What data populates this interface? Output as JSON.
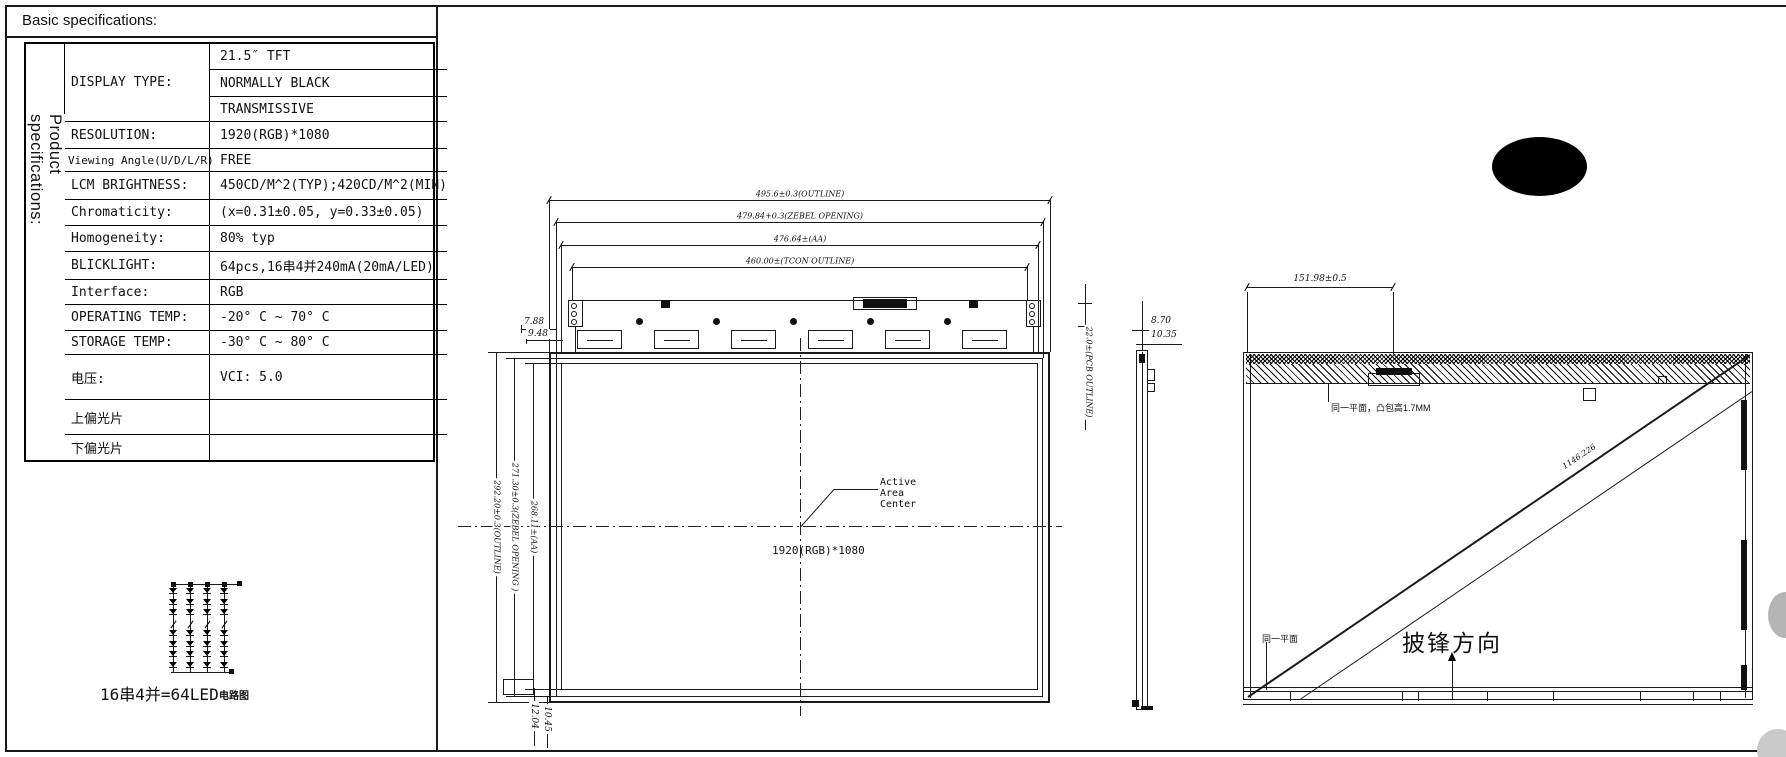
{
  "page": {
    "title": "Basic specifications:",
    "side_header": "Product specifications:"
  },
  "spec_table": {
    "display_type": {
      "label": "DISPLAY TYPE:",
      "values": [
        "21.5″ TFT",
        "NORMALLY BLACK",
        "TRANSMISSIVE"
      ]
    },
    "rows": [
      {
        "label": "RESOLUTION:",
        "value": "1920(RGB)*1080"
      },
      {
        "label": "Viewing Angle(U/D/L/R)",
        "value": "FREE"
      },
      {
        "label": "LCM BRIGHTNESS:",
        "value": "450CD/M^2(TYP);420CD/M^2(MIN)"
      },
      {
        "label": "Chromaticity:",
        "value": "(x=0.31±0.05, y=0.33±0.05)"
      },
      {
        "label": "Homogeneity:",
        "value": "80% typ"
      },
      {
        "label": "BLICKLIGHT:",
        "value": "64pcs,16串4并240mA(20mA/LED)"
      },
      {
        "label": "Interface:",
        "value": "RGB"
      },
      {
        "label": "OPERATING TEMP:",
        "value": "-20° C ~ 70° C"
      },
      {
        "label": "STORAGE TEMP:",
        "value": "-30° C ~ 80° C"
      },
      {
        "label": "电压:",
        "value": "VCI: 5.0"
      },
      {
        "label": "上偏光片",
        "value": ""
      },
      {
        "label": "下偏光片",
        "value": ""
      }
    ]
  },
  "led_diagram": {
    "label_main": "16串4并=64LED",
    "label_suffix": "电路图"
  },
  "front_view": {
    "dims_top": [
      "495.6±0.3(OUTLINE)",
      "479.84+0.3(ZEBEL OPENING)",
      "476.64±(AA)",
      "460.00±(TCON OUTLINE)"
    ],
    "dim_788": "7.88",
    "dim_948": "9.48",
    "dims_left": [
      "292.20±0.3(OUTLINE)",
      "271.30±0.3(ZEBEL OPENING )",
      "268.11±(AA)"
    ],
    "dim_1204": "12.04",
    "dim_1045": "10.45",
    "center_label_lines": [
      "Active",
      "Area",
      "Center"
    ],
    "resolution_label": "1920(RGB)*1080"
  },
  "side_view": {
    "dim_870": "8.70",
    "dim_1035": "10.35",
    "dim_pcb": "22.0±(PCB OUTLINE)"
  },
  "rear_view": {
    "dim_top": "151.98±0.5",
    "note_flat_top": "同一平面，凸包高1.7MM",
    "note_flat_bottom": "同一平面",
    "diagonal_label": "1146.226",
    "burr_direction_label": "披锋方向"
  }
}
